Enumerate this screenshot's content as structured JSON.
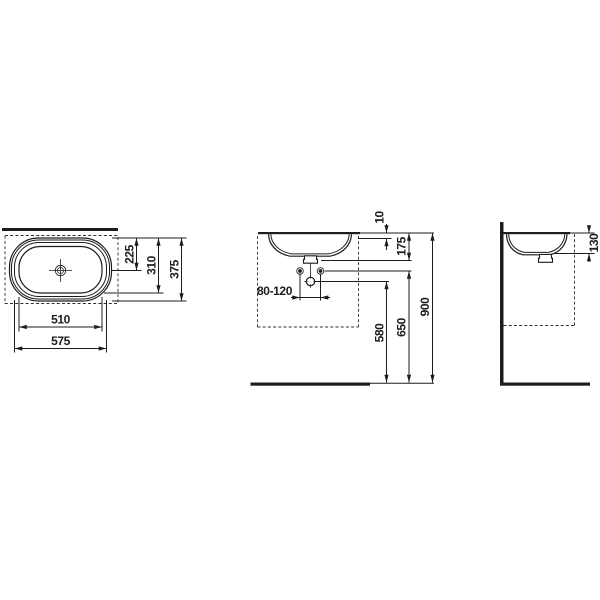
{
  "drawing": {
    "type": "washbasin-installation-dimension-drawing",
    "views": [
      "plan",
      "front",
      "side"
    ]
  },
  "colors": {
    "line": "#1d1d1b",
    "background": "#ffffff"
  },
  "dims": {
    "plan": {
      "front_to_drain": "225",
      "inner_depth": "310",
      "outer_depth": "375",
      "inner_width": "510",
      "outer_width": "575"
    },
    "front": {
      "counter_thickness": "10",
      "rim_depth": "175",
      "tap_hole_spacing": "80-120",
      "drain_height": "580",
      "fixing_holes_height": "650",
      "counter_height": "900"
    },
    "side": {
      "bowl_depth": "130"
    }
  }
}
